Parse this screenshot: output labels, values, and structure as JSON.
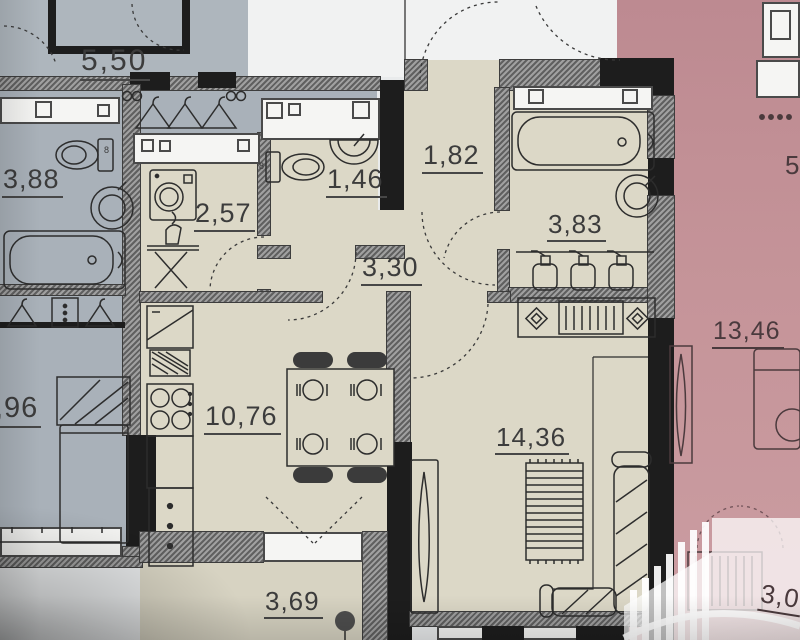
{
  "title": "apartment-floor-plan-photo",
  "plan": {
    "left_apartment": {
      "corridor_area": "5,50",
      "bathroom_area": "3,88",
      "bedroom_area_partial": ",96"
    },
    "center_apartment": {
      "laundry_area": "2,57",
      "wc_area": "1,46",
      "hall_area": "1,82",
      "bathroom_area": "3,83",
      "corridor_area": "3,30",
      "kitchen_dining_area": "10,76",
      "living_room_area": "14,36",
      "balcony_area": "3,69"
    },
    "right_apartment": {
      "room_area": "13,46",
      "partial_area_top": "5,",
      "partial_area_bottom": "3,0"
    },
    "annotations": {
      "toilet_mark_left": "8",
      "toilet_mark_wc": "8"
    },
    "colors": {
      "left_tint": "#a9b2ba",
      "center_tint": "#dcd8c7",
      "right_tint": "#c4939a",
      "wall_hatched": "#6f6f6f",
      "wall_black": "#1d1d1d",
      "background": "#e9ebec",
      "label_text": "#3c3c3c",
      "watermark": "#ffffff"
    },
    "icons": [
      "washing-machine-icon",
      "ironing-board-icon",
      "toilet-icon",
      "sink-icon",
      "bathtub-icon",
      "shower-bottles-icon",
      "hanger-icon",
      "dining-table-icon",
      "chair-icon",
      "plate-icon",
      "stove-icon",
      "fridge-icon",
      "kitchen-sink-icon",
      "sofa-icon",
      "rug-icon",
      "tv-icon",
      "bed-icon",
      "plant-icon",
      "door-swing-icon",
      "sideboard-icon",
      "wardrobe-icon",
      "radiator-icon",
      "developer-watermark-logo"
    ]
  }
}
